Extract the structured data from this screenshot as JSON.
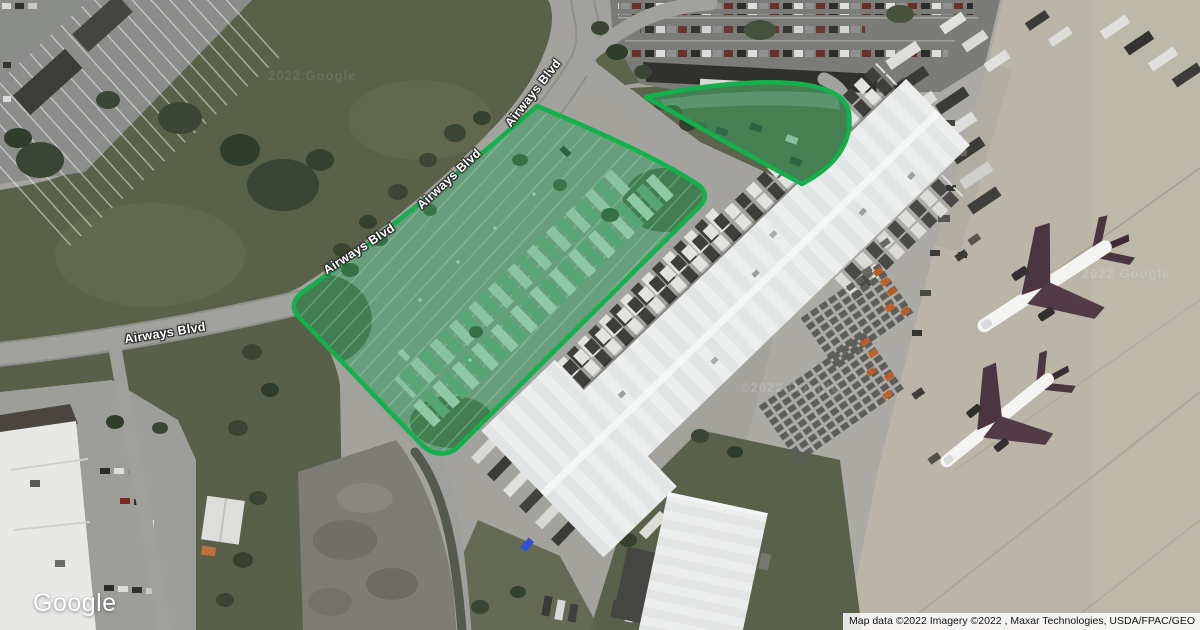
{
  "map": {
    "road_labels": [
      {
        "text": "Airways Blvd"
      },
      {
        "text": "Airways Blvd"
      },
      {
        "text": "Airways Blvd"
      },
      {
        "text": "Airways Blvd"
      }
    ],
    "watermarks": [
      "2022 Google",
      "©2022 Google",
      "2022 Google"
    ],
    "logo_text": "Google",
    "attribution": "Map data ©2022 Imagery ©2022 , Maxar Technologies, USDA/FPAC/GEO",
    "highlight_stroke_color": "#12b14b",
    "highlight_fill_color": "#2aa159"
  }
}
